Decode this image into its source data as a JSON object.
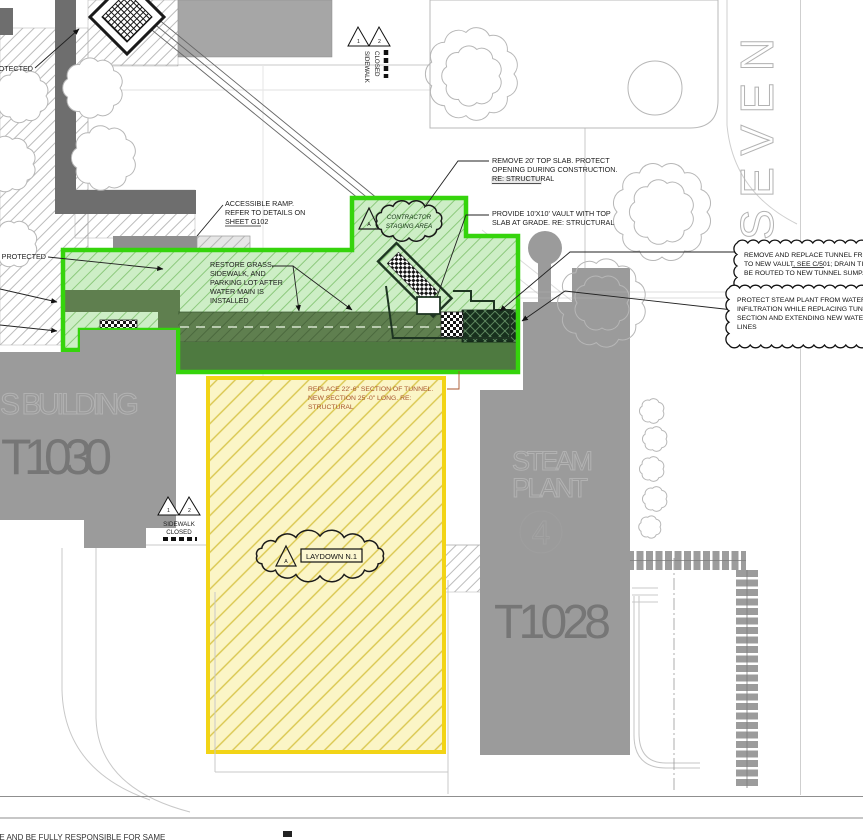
{
  "colors": {
    "zone_green_border": "#35d40c",
    "zone_green_fill": "#cdeec6",
    "zone_yellow_border": "#f2d416",
    "zone_yellow_fill": "#fbf5c6",
    "tunnel_olive": "#5f7f4f",
    "tunnel_dark": "#17301d",
    "building_gray": "#9b9b9b",
    "path_gray": "#6e6e6e",
    "note_red_text": "#a8562c"
  },
  "callouts": {
    "remove_top_slab": {
      "lines": [
        "REMOVE 20' TOP SLAB. PROTECT",
        "OPENING DURING CONSTRUCTION.",
        "RE: STRUCTURAL"
      ]
    },
    "provide_vault": {
      "lines": [
        "PROVIDE 10'X10' VAULT WITH TOP",
        "SLAB AT GRADE. RE: STRUCTURAL"
      ]
    },
    "accessible_ramp": {
      "lines": [
        "ACCESSIBLE RAMP.",
        "REFER TO DETAILS ON",
        "SHEET G102"
      ]
    },
    "restore_surfaces": {
      "lines": [
        "RESTORE GRASS,",
        "SIDEWALK, AND",
        "PARKING LOT AFTER",
        "WATER MAIN IS",
        "INSTALLED"
      ]
    },
    "replace_tunnel": {
      "lines": [
        "REPLACE 22'-6\" SECTION OF TUNNEL.",
        "NEW SECTION 25'-0\" LONG. RE:",
        "STRUCTURAL"
      ]
    },
    "protected_upper": "PROTECTED",
    "protected_lower": "PROTECTED",
    "note_tunnel_vault": {
      "lines": [
        "REMOVE AND REPLACE TUNNEL FROM STE",
        "TO NEW VAULT, SEE C/501; DRAIN TILE SHA",
        "BE ROUTED TO NEW TUNNEL SUMP."
      ]
    },
    "note_protect_steam": {
      "lines": [
        "PROTECT STEAM PLANT FROM WATER",
        "INFILTRATION WHILE REPLACING TUNNEL",
        "SECTION AND EXTENDING NEW WATER",
        "LINES"
      ]
    }
  },
  "zones": {
    "contractor_staging": {
      "lines": [
        "CONTRACTOR",
        "STAGING AREA"
      ],
      "revision": "A"
    },
    "laydown": {
      "label": "LAYDOWN N.1",
      "revision": "A"
    }
  },
  "signs": {
    "sidewalk_closed_top": {
      "line1": "SIDEWALK",
      "line2": "CLOSED",
      "deltas": [
        "1",
        "2"
      ]
    },
    "sidewalk_closed_left": {
      "line1": "SIDEWALK",
      "line2": "CLOSED",
      "deltas": [
        "1",
        "2"
      ]
    }
  },
  "buildings": {
    "t1030": {
      "name": "S  BUILDING",
      "number": "T1030"
    },
    "steam_plant": {
      "name_line1": "STEAM",
      "name_line2": "PLANT",
      "unit": "4",
      "number": "T1028"
    }
  },
  "street": {
    "name": "SEVEN"
  },
  "footer": {
    "partial_note": "EE AND BE FULLY RESPONSIBLE FOR SAME"
  }
}
